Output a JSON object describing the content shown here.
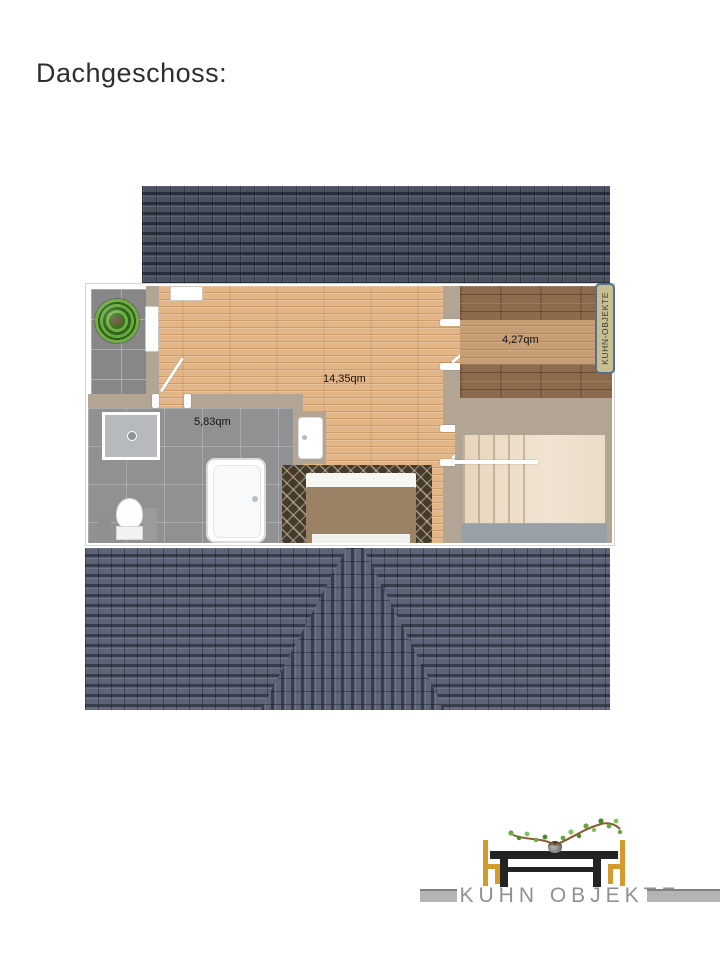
{
  "page": {
    "title": "Dachgeschoss:"
  },
  "floorplan": {
    "watermark": "KUHN-OBJEKTE",
    "rooms": {
      "living": {
        "area": "14,35qm"
      },
      "side": {
        "area": "4,27qm"
      },
      "bath": {
        "area": "5,83qm"
      }
    }
  },
  "logo": {
    "text": "KUHN OBJEKTE"
  },
  "colors": {
    "roof_top": "#4a5160",
    "roof_bottom": "#5d6477",
    "wall": "#b3a593",
    "wood_floor": "#e3b687",
    "rustic_wood": "#8d6a4b",
    "bath_tile": "#8f9193",
    "balcony_tile": "#878787",
    "stairs": "#ecdfca",
    "chair_gold": "#d29b2b",
    "table_black": "#232323",
    "logo_text_gray": "#909090",
    "badge_bg": "#c8be93",
    "badge_border": "#53718a"
  }
}
